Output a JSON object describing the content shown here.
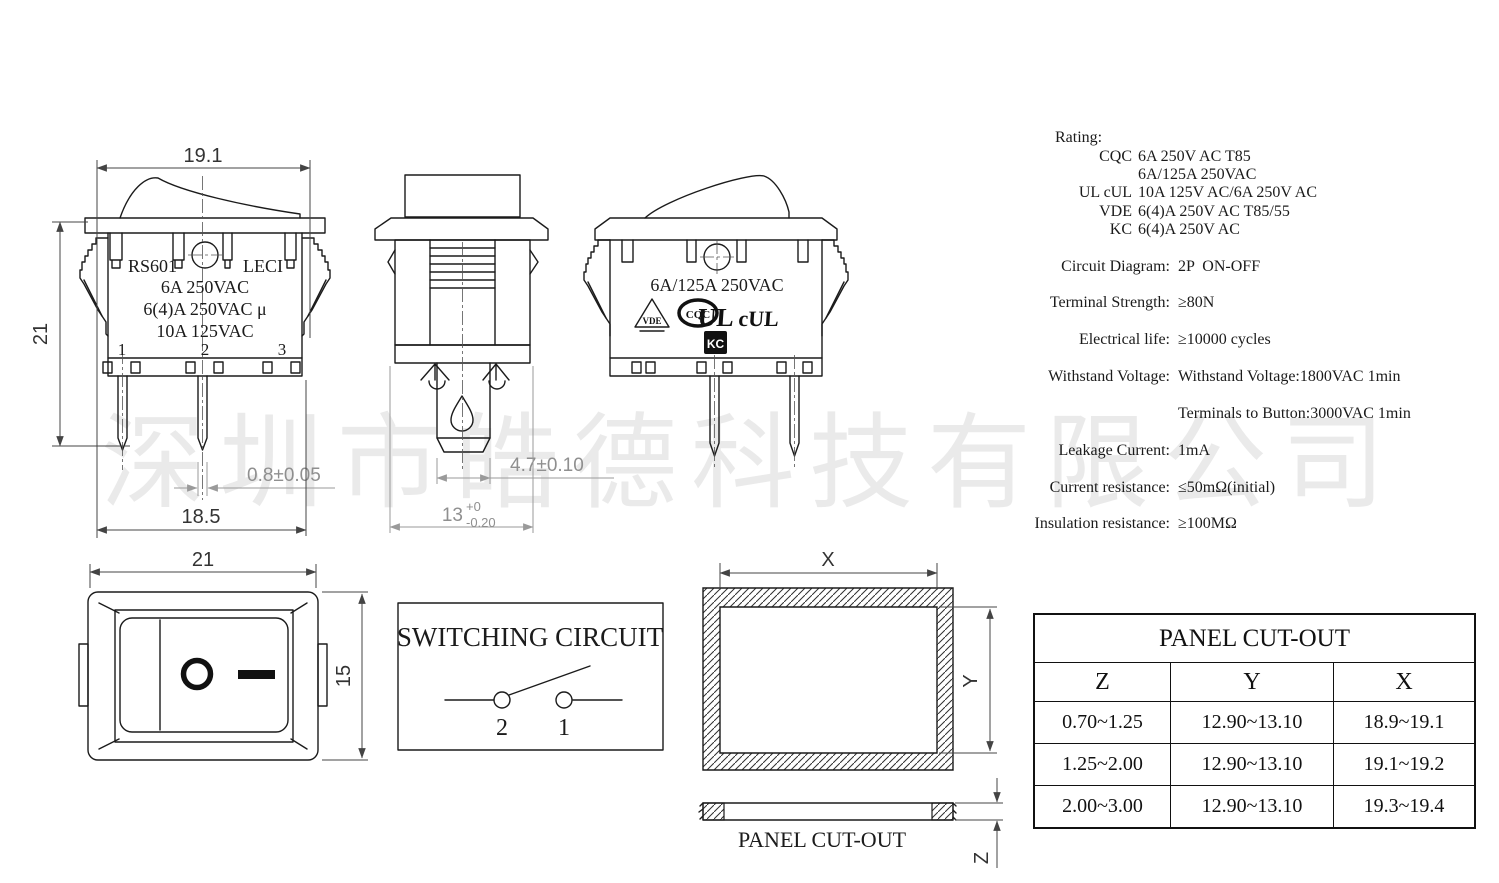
{
  "watermark": "深圳市皓德科技有限公司",
  "front_view": {
    "dim_top_width": "19.1",
    "dim_left_height": "21",
    "dim_pin_width": "0.8±0.05",
    "dim_bottom_width": "18.5",
    "marking_left": "RS601",
    "marking_right": "LECI",
    "rating_line1": "6A 250VAC",
    "rating_line2": "6(4)A 250VAC μ",
    "rating_line3": "10A 125VAC",
    "terminals": [
      "1",
      "2",
      "3"
    ]
  },
  "side_view": {
    "dim_terminal_width": "4.7±0.10",
    "dim_depth": "13",
    "dim_depth_tol_top": "+0",
    "dim_depth_tol_bottom": "-0.20"
  },
  "back_view": {
    "marking": "6A/125A 250VAC",
    "certifications": [
      "VDE",
      "CQC",
      "UL",
      "cUL",
      "KC"
    ]
  },
  "top_view": {
    "dim_width": "21",
    "dim_height": "15"
  },
  "specs": {
    "rating_label": "Rating:",
    "rating_lines": [
      {
        "agency": "CQC",
        "value": "6A 250V AC T85"
      },
      {
        "agency": "",
        "value": "6A/125A 250VAC"
      },
      {
        "agency": "UL cUL",
        "value": "10A 125V AC/6A 250V AC"
      },
      {
        "agency": "VDE",
        "value": "6(4)A 250V AC T85/55"
      },
      {
        "agency": "KC",
        "value": "6(4)A 250V AC"
      }
    ],
    "items": [
      {
        "label": "Circuit Diagram:",
        "value": "2P  ON-OFF"
      },
      {
        "label": "Terminal Strength:",
        "value": "≥80N"
      },
      {
        "label": "Electrical life:",
        "value": "≥10000 cycles"
      },
      {
        "label": "Withstand Voltage:",
        "value": "Withstand Voltage:1800VAC 1min"
      },
      {
        "label": "",
        "value": "Terminals to Button:3000VAC 1min"
      },
      {
        "label": "Leakage Current:",
        "value": "1mA"
      },
      {
        "label": "Current resistance:",
        "value": "≤50mΩ(initial)"
      },
      {
        "label": "Insulation resistance:",
        "value": "≥100MΩ"
      }
    ]
  },
  "switching_circuit": {
    "title": "SWITCHING CIRCUIT",
    "terminal_left": "2",
    "terminal_right": "1"
  },
  "panel_cutout": {
    "dim_x": "X",
    "dim_y": "Y",
    "dim_z": "Z",
    "caption": "PANEL CUT-OUT"
  },
  "panel_cutout_table": {
    "title": "PANEL CUT-OUT",
    "columns": [
      "Z",
      "Y",
      "X"
    ],
    "rows": [
      [
        "0.70~1.25",
        "12.90~13.10",
        "18.9~19.1"
      ],
      [
        "1.25~2.00",
        "12.90~13.10",
        "19.1~19.2"
      ],
      [
        "2.00~3.00",
        "12.90~13.10",
        "19.3~19.4"
      ]
    ]
  }
}
